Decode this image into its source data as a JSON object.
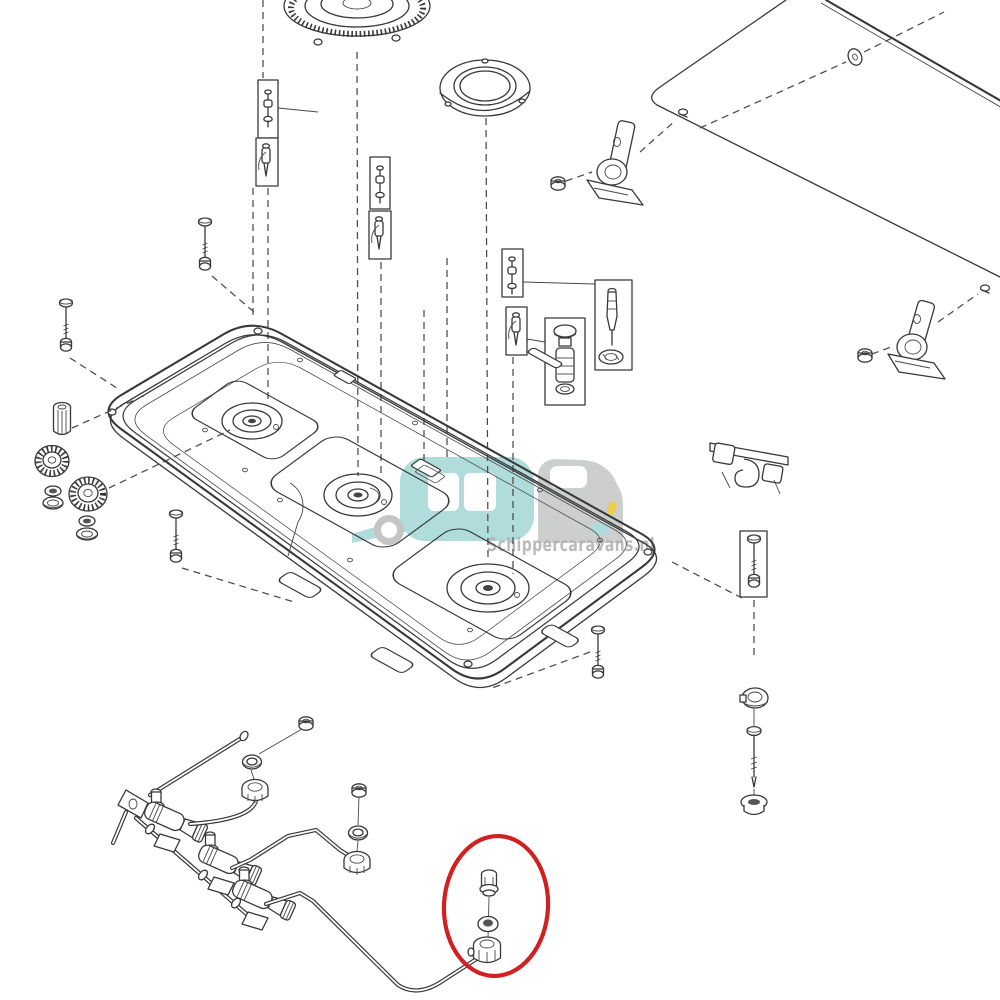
{
  "watermark": {
    "text": "Schippercaravans.nl",
    "logo": {
      "caravan_shape": "caravan-silhouette",
      "car_shape": "car-silhouette",
      "wheel_shape": "wheel-ring"
    }
  },
  "colors": {
    "highlight_red": "#d22020",
    "caravan_teal": "#aadbda",
    "car_gray": "#c9cbca",
    "accent_yellow": "#e7c93f",
    "wheel_gray": "#bfc1c0",
    "text_gray": "#ababab"
  },
  "highlight": {
    "shape": "ellipse",
    "marks_part": "jet-nozzle-set-3"
  },
  "diagram": {
    "type": "exploded-parts-diagram",
    "subject": "three-burner gas hob",
    "parts": [
      "glass-lid-panel",
      "lid-grommet",
      "lid-screws",
      "lid-hinge-bracket-left",
      "lid-hinge-bracket-right",
      "hinge-nuts",
      "burner-cap-large",
      "burner-ring",
      "boxed-igniter-jet-parts",
      "boxed-electrode-parts",
      "boxed-injector-set",
      "boxed-spark-electrode",
      "main-hob-tray",
      "burner-well-left",
      "burner-well-center",
      "burner-well-right",
      "knurled-burner-cap-small",
      "knurled-burner-cap-medium",
      "washers-and-base-rings",
      "igniter-barrel",
      "mounting-screws",
      "pan-support-latch",
      "clamp-ring",
      "long-screw",
      "grommet-cap",
      "gas-supply-tube",
      "manifold-rail",
      "gas-valve-1",
      "gas-valve-2",
      "gas-valve-3",
      "burner-feed-pipe-1",
      "burner-feed-pipe-2",
      "burner-feed-pipe-3",
      "jet-nozzle-set-1",
      "jet-nozzle-set-2",
      "jet-nozzle-set-3"
    ]
  }
}
